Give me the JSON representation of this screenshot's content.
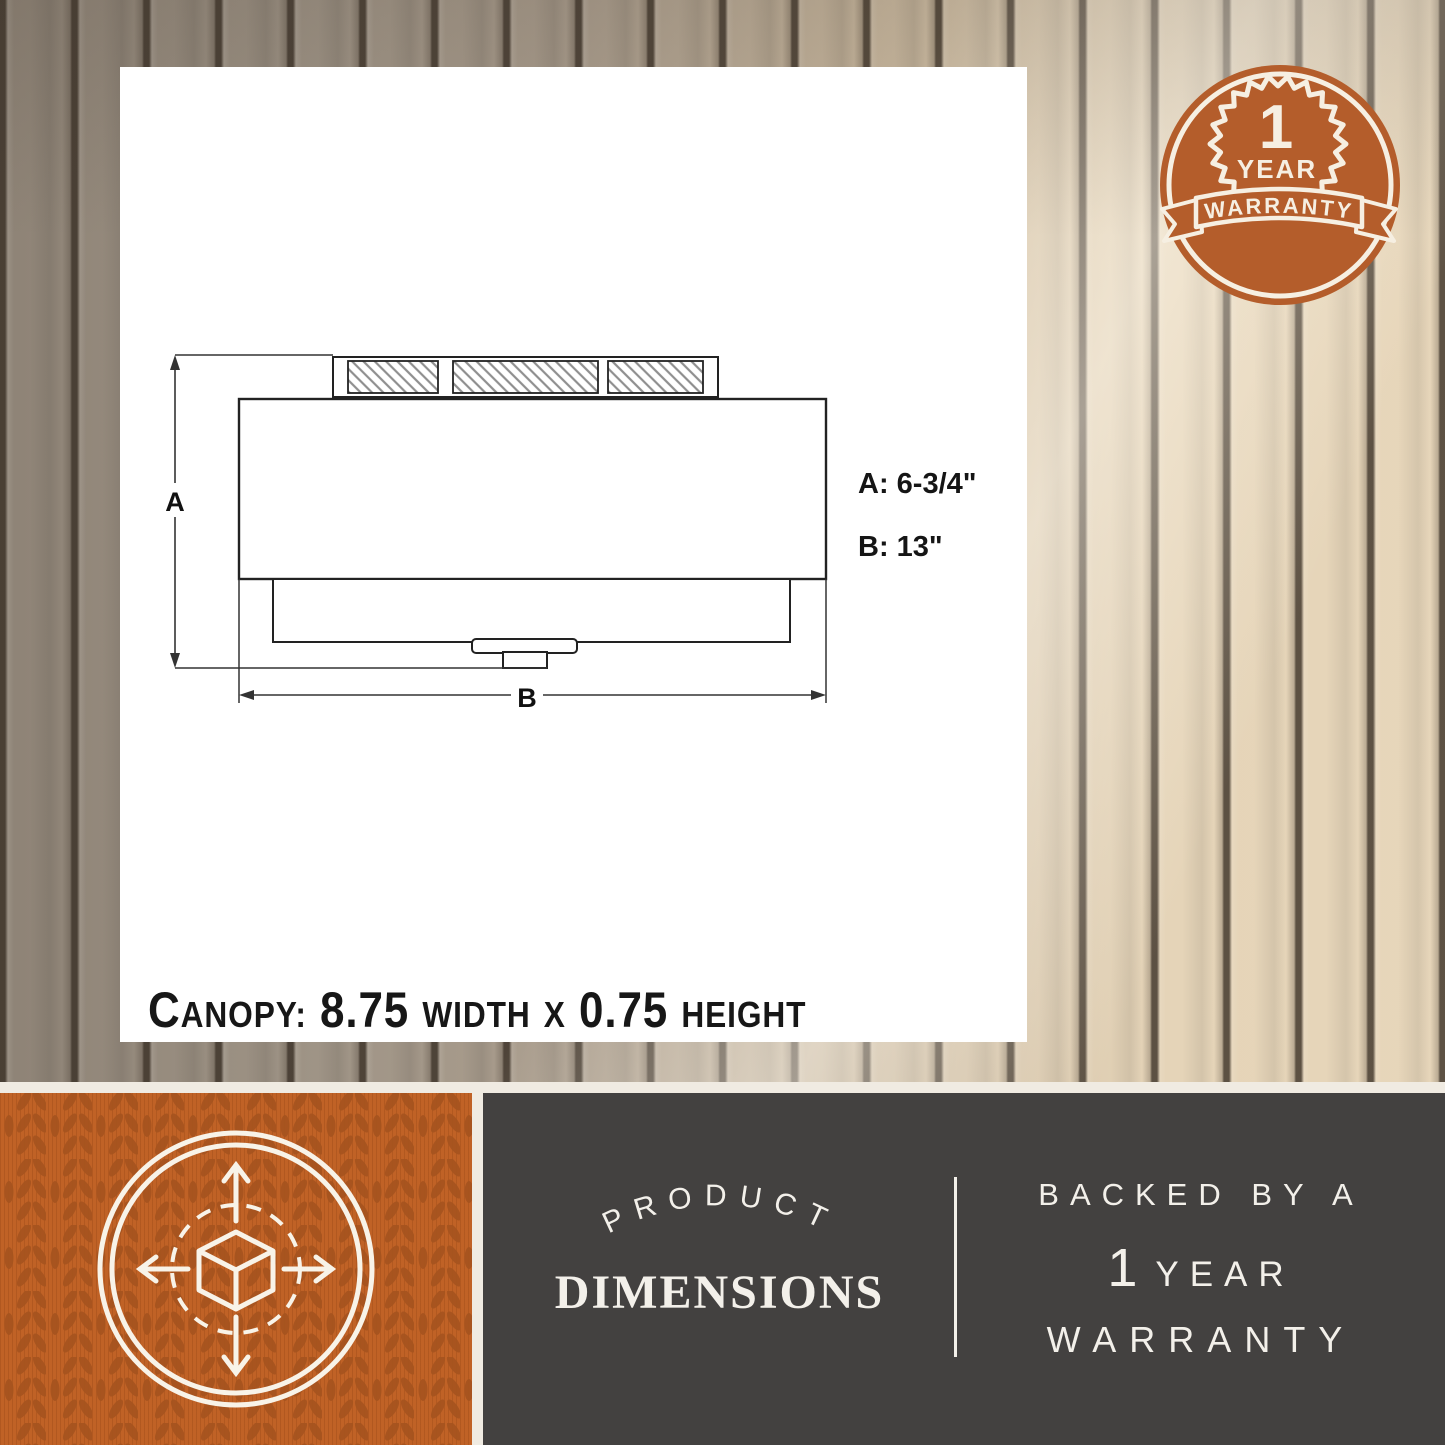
{
  "diagram": {
    "dim_a_label": "A",
    "dim_b_label": "B",
    "spec_a": "A: 6-3/4\"",
    "spec_b": "B: 13\"",
    "canopy": {
      "label": "Canopy:",
      "width_value": "8.75",
      "width_word": "width",
      "times": "x",
      "height_value": "0.75",
      "height_word": "height"
    }
  },
  "badge": {
    "number": "1",
    "year": "YEAR",
    "ribbon": "WARRANTY"
  },
  "panels": {
    "product": {
      "arch": "PRODUCT",
      "title": "DIMENSIONS"
    },
    "warranty": {
      "line1": "BACKED BY A",
      "number": "1",
      "year": "YEAR",
      "line3": "WARRANTY"
    }
  },
  "colors": {
    "accent_orange": "#c06226",
    "badge_orange": "#b45d2b",
    "panel_dark": "#434140",
    "cream": "#f4f0e8",
    "ink": "#222222"
  }
}
